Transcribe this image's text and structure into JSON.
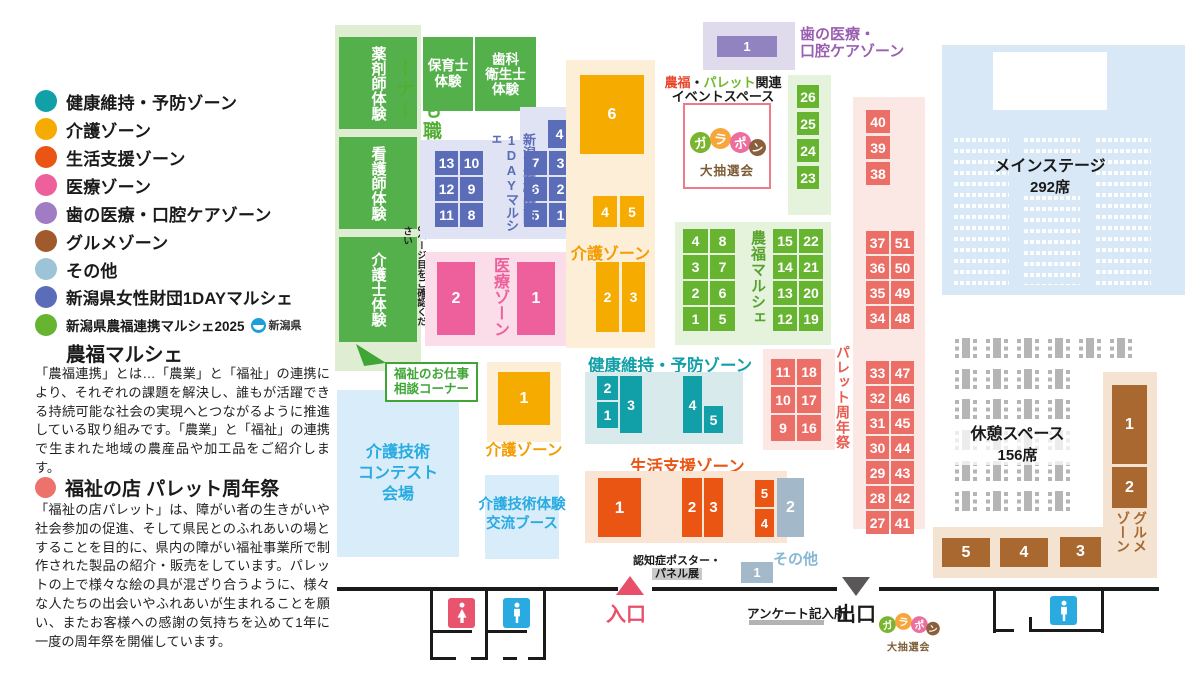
{
  "colors": {
    "kenko_teal": "#12a0a8",
    "kaigo_amber": "#f6ab00",
    "seikatsu_orange": "#ea5514",
    "iryo_pink": "#ee609c",
    "ha_purple": "#a07cc5",
    "gourmet_brown": "#a05a2c",
    "sonota_blue": "#9cc3d6",
    "oneday_blue": "#5b6db8",
    "nofuku_green": "#66b42f",
    "palette_salmon": "#ed726b",
    "entrance_red": "#e8506a",
    "info_blue": "#29abe2"
  },
  "legend": {
    "items": [
      {
        "label": "健康維持・予防ゾーン",
        "color": "#12a0a8"
      },
      {
        "label": "介護ゾーン",
        "color": "#f6ab00"
      },
      {
        "label": "生活支援ゾーン",
        "color": "#ea5514"
      },
      {
        "label": "医療ゾーン",
        "color": "#ee609c"
      },
      {
        "label": "歯の医療・口腔ケアゾーン",
        "color": "#a07cc5"
      },
      {
        "label": "グルメゾーン",
        "color": "#a05a2c"
      },
      {
        "label": "その他",
        "color": "#9cc3d6"
      },
      {
        "label": "新潟県女性財団1DAYマルシェ",
        "color": "#5b6db8"
      }
    ],
    "marche2025": {
      "line1": "新潟県農福連携マルシェ2025",
      "pref": "新潟県",
      "line2": "農福マルシェ",
      "color": "#66b42f"
    },
    "nofuku_desc": "「農福連携」とは…「農業」と「福祉」の連携により、それぞれの課題を解決し、誰もが活躍できる持続可能な社会の実現へとつながるように推進している取り組みです。「農業」と「福祉」の連携で生まれた地域の農産品や加工品をご紹介します。",
    "palette_title": "福祉の店 パレット周年祭",
    "palette_color": "#ed726b",
    "palette_desc": "「福祉の店パレット」は、障がい者の生きがいや社会参加の促進、そして県民とのふれあいの場とすることを目的に、県内の障がい福祉事業所で制作された製品の紹介・販売をしています。パレットの上で様々な絵の具が混ざり合うように、様々な人たちの出会いやふれあいが生まれることを願い、またお客様への感謝の気持ちを込めて1年に一度の周年祭を開催しています。"
  },
  "map": {
    "kids": {
      "title": "こども職業体験コーナー",
      "note": "3ページ目をご確認ください",
      "blocks": [
        "薬剤師体験",
        "看護師体験",
        "介護士体験"
      ],
      "hoiku": "保育士\n体験",
      "shika": "歯科\n衛生士\n体験"
    },
    "oneday": {
      "label": "新潟県女性財団\n1DAYマルシェ",
      "cells_left": [
        "13",
        "10",
        "12",
        "9",
        "11",
        "8"
      ],
      "cell_top": "4",
      "cells_right": [
        "7",
        "3",
        "6",
        "2",
        "5",
        "1"
      ]
    },
    "iryo": {
      "label": "医療ゾーン",
      "cells": [
        "2",
        "1"
      ]
    },
    "kaigo": {
      "label": "介護ゾーン",
      "cell6": "6",
      "cells45": [
        "4",
        "5"
      ],
      "cells23": [
        "2",
        "3"
      ],
      "cell1": "1"
    },
    "kenko": {
      "label": "健康維持・予防ゾーン",
      "cells": [
        "2",
        "1",
        "3",
        "4",
        "5"
      ]
    },
    "seikatsu": {
      "label": "生活支援ゾーン",
      "cells": [
        "1",
        "2",
        "3",
        "5",
        "4"
      ]
    },
    "sonota": {
      "label": "その他",
      "cell_a": "2",
      "cell_b": "1"
    },
    "ninchisho": {
      "line1": "認知症ポスター・",
      "line2": "パネル展"
    },
    "event": {
      "l1a": "農福",
      "l1b": "・",
      "l1c": "パレット",
      "l1d": "関連",
      "l2": "イベントスペース"
    },
    "garapon": {
      "c1": "ガ",
      "c2": "ラ",
      "c3": "ポ",
      "c4": "ン",
      "sub": "大抽選会"
    },
    "nofuku": {
      "label": "農福マルシェ",
      "col": [
        "26",
        "25",
        "24",
        "23"
      ],
      "left": [
        "4",
        "8",
        "3",
        "7",
        "2",
        "6",
        "1",
        "5"
      ],
      "right": [
        "15",
        "22",
        "14",
        "21",
        "13",
        "20",
        "12",
        "19"
      ]
    },
    "palette": {
      "label": "パレット周年祭",
      "top": [
        "40",
        "39",
        "38"
      ],
      "a": [
        "37",
        "51",
        "36",
        "50",
        "35",
        "49",
        "34",
        "48"
      ],
      "b": [
        "33",
        "47",
        "32",
        "46",
        "31",
        "45",
        "30",
        "44",
        "29",
        "43",
        "28",
        "42",
        "27",
        "41"
      ],
      "small": [
        "11",
        "18",
        "10",
        "17",
        "9",
        "16"
      ]
    },
    "stage": {
      "title": "メインステージ",
      "seats": "292席"
    },
    "rest": {
      "title": "休憩スペース",
      "seats": "156席",
      "row6": [
        "",
        "",
        "",
        "",
        "",
        ""
      ],
      "row4": [
        "",
        "",
        "",
        ""
      ]
    },
    "gourmet": {
      "label": "グルメ\nゾーン",
      "c1": "1",
      "c2": "2",
      "bottom": [
        "5",
        "4",
        "3"
      ]
    },
    "ha": {
      "label": "歯の医療・\n口腔ケアゾーン",
      "cell": "1"
    },
    "contest": {
      "label": "介護技術\nコンテスト\n会場"
    },
    "taiken": {
      "label": "介護技術体験\n交流ブース"
    },
    "consult": {
      "label": "福祉のお仕事\n相談コーナー"
    },
    "entrance": "入口",
    "exit": "出口",
    "survey": "アンケート記入所"
  }
}
